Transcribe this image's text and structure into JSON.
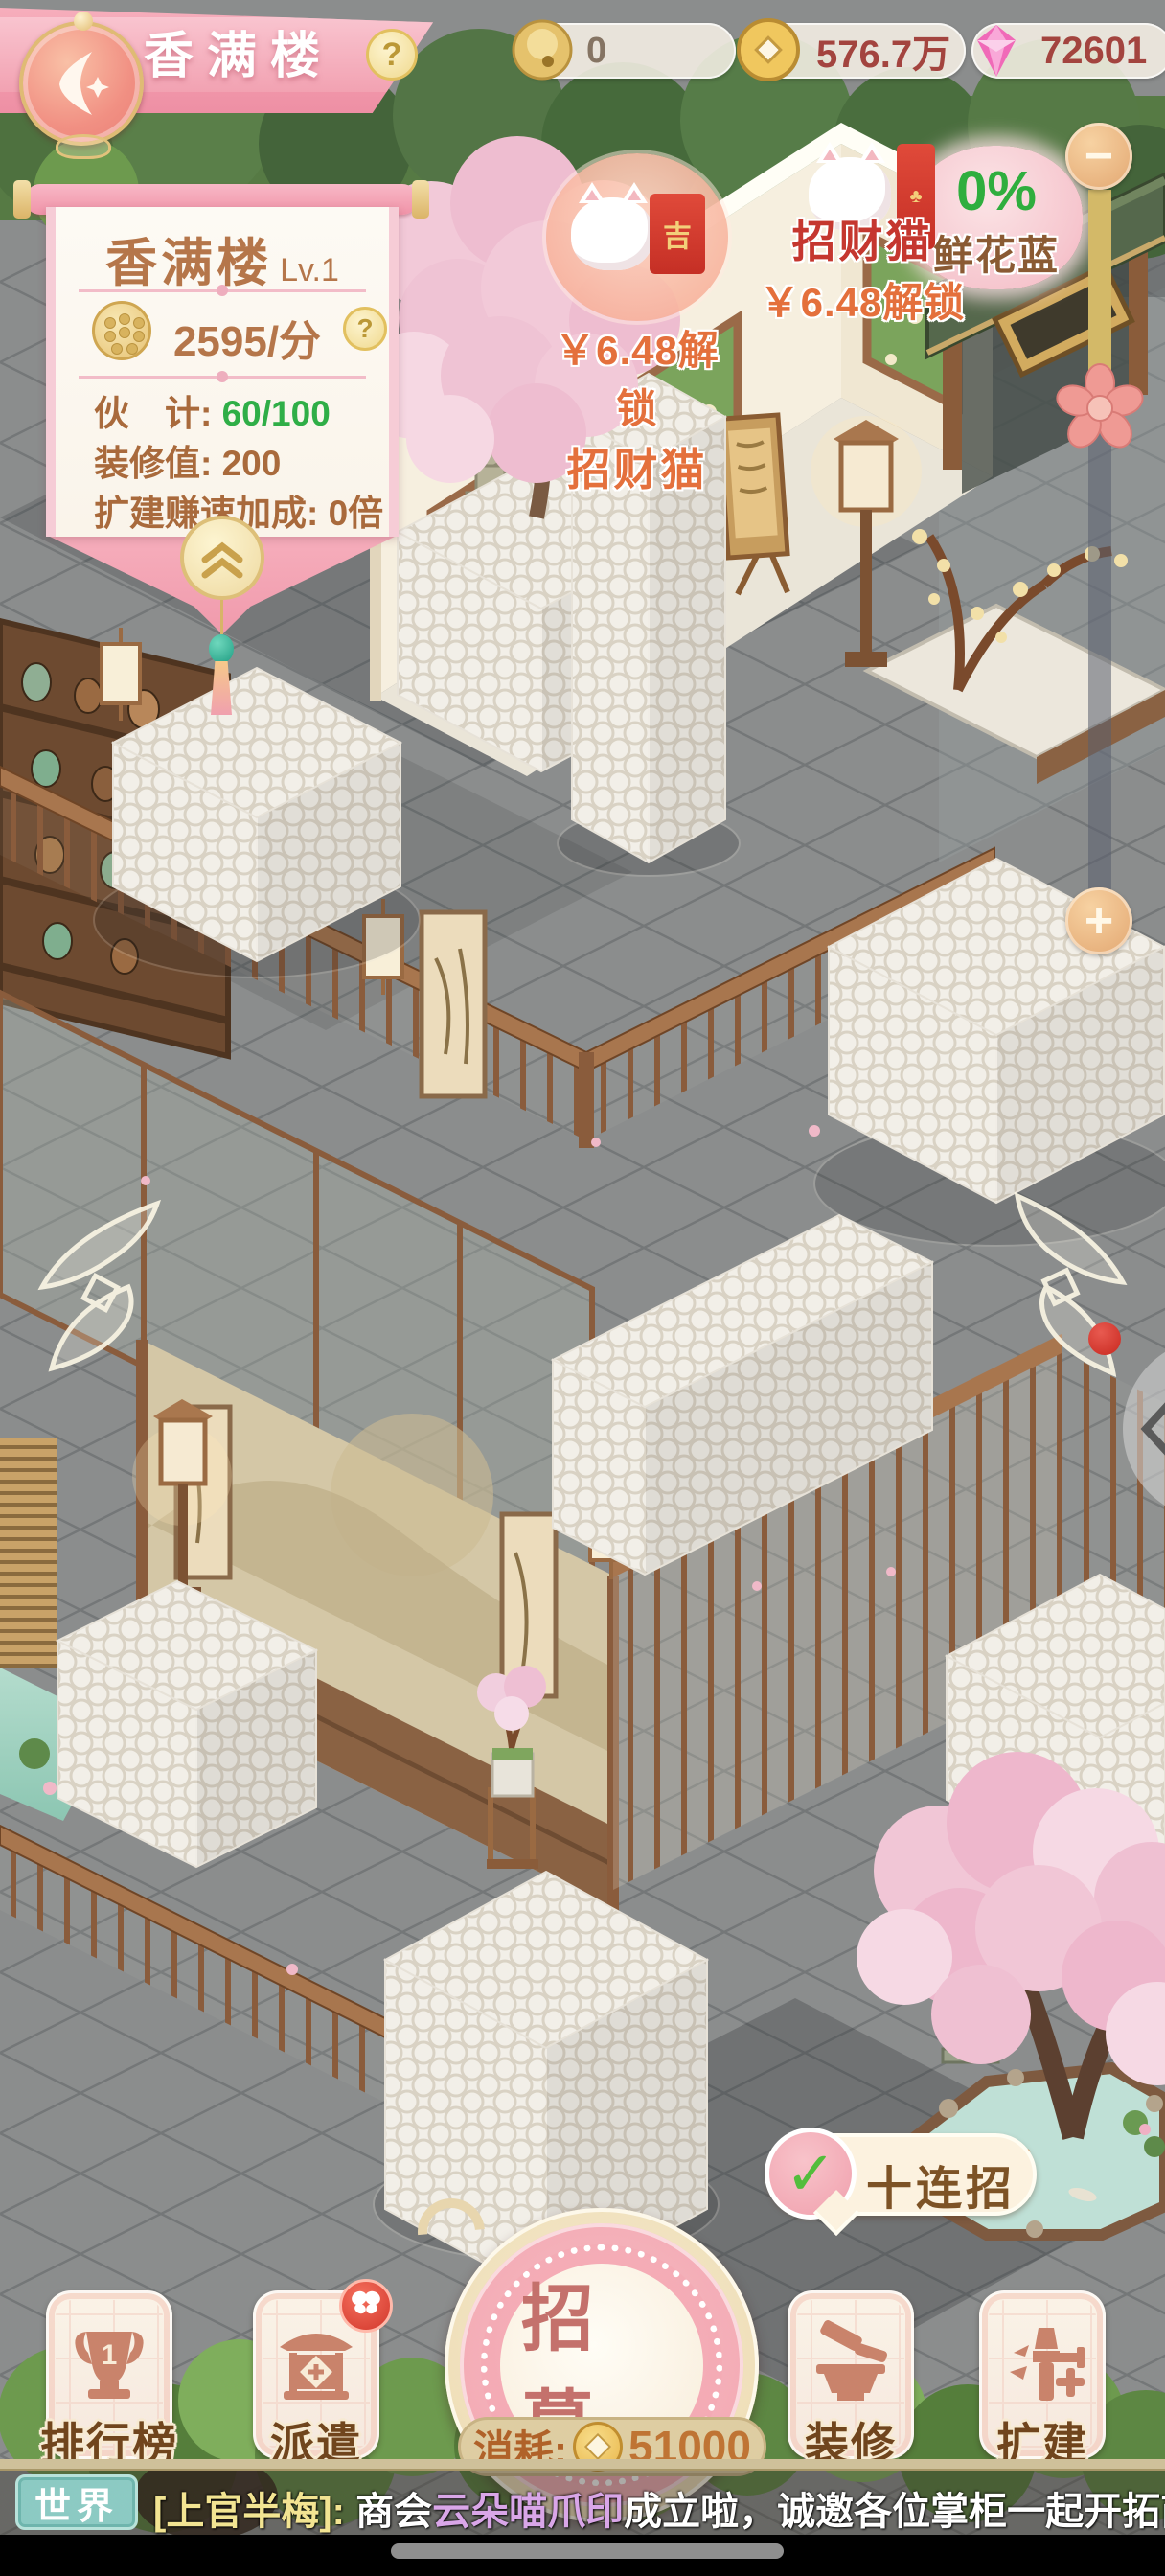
{
  "header": {
    "title": "香满楼",
    "help_label": "?",
    "currencies": [
      {
        "icon": "bell-coin-icon",
        "value": "0"
      },
      {
        "icon": "gold-coin-icon",
        "value": "576.7万"
      },
      {
        "icon": "diamond-icon",
        "value": "72601"
      }
    ]
  },
  "info_panel": {
    "name": "香满楼",
    "level": "Lv.1",
    "rate": "2595/分",
    "help_label": "?",
    "stats": [
      {
        "label": "伙　计:",
        "value": "60/100"
      },
      {
        "label": "装修值:",
        "value": "200"
      },
      {
        "label": "扩建赚速加成:",
        "value": "0倍"
      }
    ]
  },
  "floating": {
    "cat_left": {
      "price": "￥6.48解锁",
      "name": "招财猫",
      "envelope_char": "吉"
    },
    "cat_right": {
      "name": "招财猫",
      "price": "￥6.48解锁"
    },
    "flower_basket": {
      "percent": "0%",
      "label": "鲜花蓝"
    }
  },
  "zoom_slider": {
    "minus": "−",
    "plus": "+"
  },
  "recruit": {
    "bubble_check": "✓",
    "bubble_label": "十连招",
    "button_label": "招募",
    "cost_label": "消耗:",
    "cost_value": "51000"
  },
  "bottom_buttons": [
    {
      "label": "排行榜",
      "icon": "trophy-icon"
    },
    {
      "label": "派遣",
      "icon": "pavilion-icon",
      "badge": "butterfly-icon"
    },
    {
      "label": "装修",
      "icon": "furniture-icon"
    },
    {
      "label": "扩建",
      "icon": "hammer-icon"
    }
  ],
  "chat": {
    "channel": "世界",
    "segments": [
      {
        "text": "[上官半梅]:",
        "color": "#f2e492"
      },
      {
        "text": " 商会",
        "color": "#ffffff"
      },
      {
        "text": "云朵喵爪印",
        "color": "#d9a6e8"
      },
      {
        "text": "成立啦，诚邀各位掌柜一起开拓商界，",
        "color": "#ffffff"
      },
      {
        "text": "我",
        "color": "#6ed257"
      }
    ]
  },
  "colors": {
    "banner_pink": "#f2a0b2",
    "gold": "#e8c878",
    "currency_red": "#a3443f",
    "stat_green": "#2fae47",
    "channel_teal": "#8ccac3",
    "badge_red": "#d2372b",
    "slider_fill": "#d3b968"
  }
}
